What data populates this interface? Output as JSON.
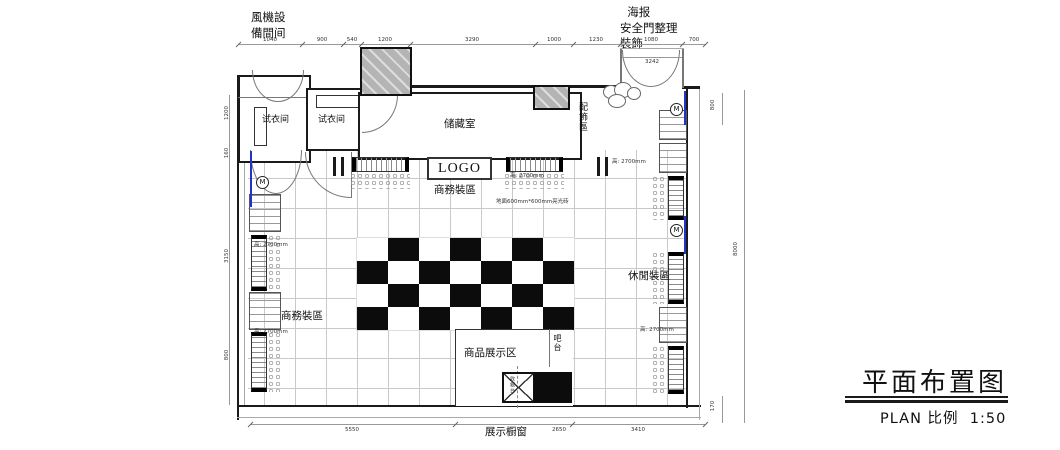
{
  "title_block": {
    "title": "平面布置图",
    "scale": "PLAN 比例  1:50"
  },
  "annotations": {
    "fan_room": "風機設\n備間间",
    "entry_note": "  海报\n安全門整理\n裝飾"
  },
  "rooms": {
    "fitting": "试衣间",
    "storage": "储藏室",
    "logo": "LOGO",
    "business": "商務裝區",
    "accessories": "配飾區",
    "casual": "休閒裝區",
    "display": "商品展示区",
    "bar": "吧台",
    "cashier": "收銀台",
    "window": "展示橱窗"
  },
  "notes": {
    "rack_height": "高: 2700mm",
    "floor": "地面600mm*600mm亮光砖"
  },
  "symbols": {
    "mirror": "M"
  },
  "dims": {
    "top": [
      "1040",
      "900",
      "540",
      "1200",
      "3290",
      "1000",
      "1230",
      "1080",
      "700"
    ],
    "entry": "3242",
    "bottom": [
      "5550",
      "2650",
      "3410"
    ],
    "left": [
      "1200",
      "160",
      "3150",
      "800"
    ],
    "right": [
      "800",
      "8000",
      "170"
    ]
  }
}
